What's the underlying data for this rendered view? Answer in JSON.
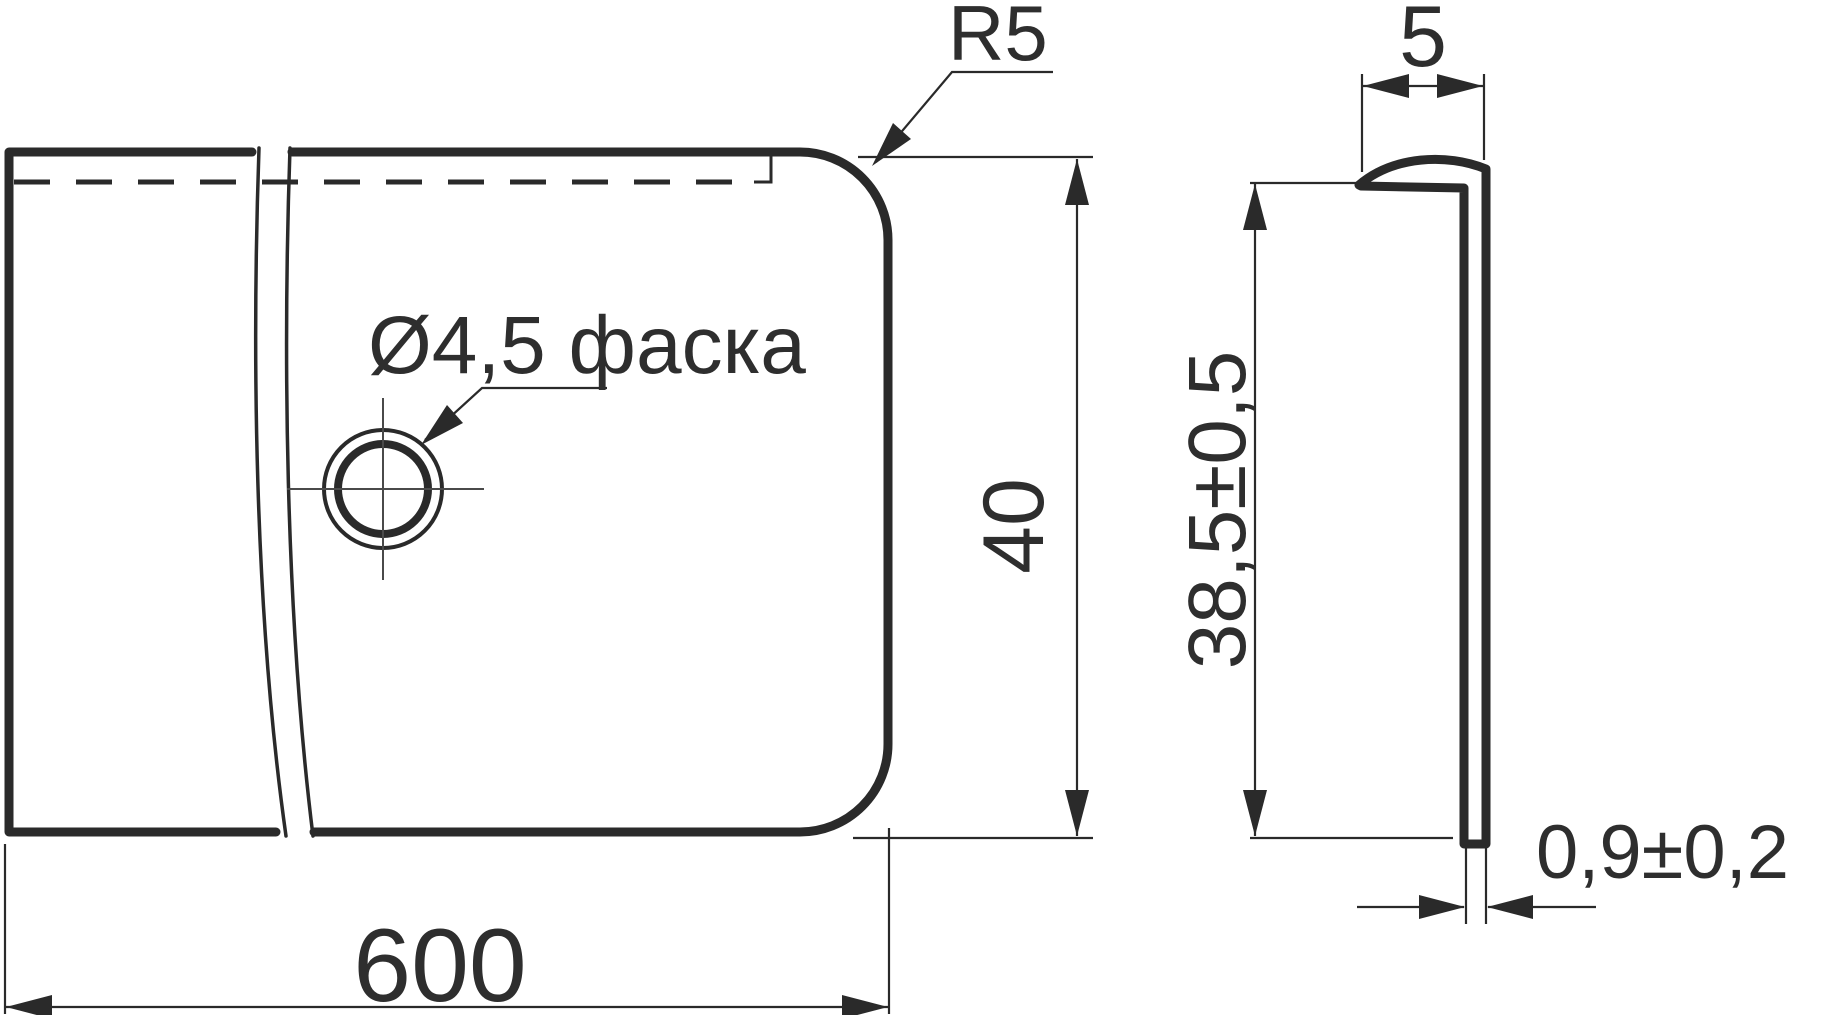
{
  "drawing": {
    "front_view": {
      "width_dim": "600",
      "height_dim": "40",
      "corner_radius_label": "R5",
      "hole_callout": "Ø4,5 фаска"
    },
    "side_view": {
      "flange_width_dim": "5",
      "height_dim": "38,5±0,5",
      "thickness_dim": "0,9±0,2"
    },
    "colors": {
      "line": "#2a2a2a",
      "text": "#2e2e2e",
      "background": "#ffffff"
    }
  }
}
